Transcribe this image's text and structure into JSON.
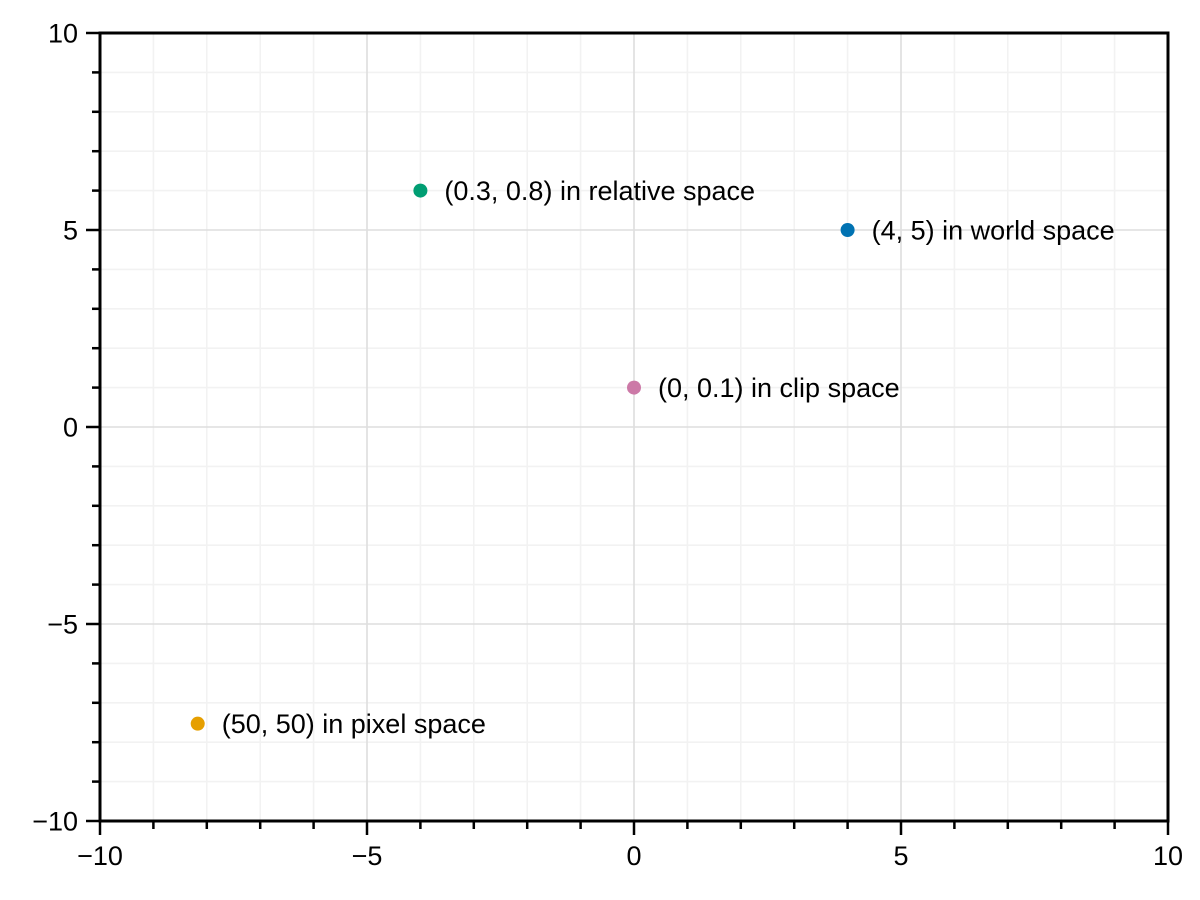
{
  "chart_data": {
    "type": "scatter",
    "title": "",
    "xlabel": "",
    "ylabel": "",
    "xlim": [
      -10,
      10
    ],
    "ylim": [
      -10,
      10
    ],
    "grid": {
      "minor": true,
      "major": true,
      "minor_step": 1,
      "major_step": 5
    },
    "legend_position": "none",
    "x_major_ticks": [
      -10,
      -5,
      0,
      5,
      10
    ],
    "x_major_tick_labels": [
      "−10",
      "−5",
      "0",
      "5",
      "10"
    ],
    "y_major_ticks": [
      -10,
      -5,
      0,
      5,
      10
    ],
    "y_major_tick_labels": [
      "−10",
      "−5",
      "0",
      "5",
      "10"
    ],
    "points": [
      {
        "x": -4,
        "y": 6,
        "color": "#009E73",
        "label": "(0.3, 0.8) in relative space"
      },
      {
        "x": 4,
        "y": 5,
        "color": "#0072B2",
        "label": "(4, 5) in world space"
      },
      {
        "x": 0,
        "y": 1,
        "color": "#CC79A7",
        "label": "(0, 0.1) in clip space"
      },
      {
        "x": -8.17,
        "y": -7.53,
        "color": "#E69F00",
        "label": "(50, 50) in pixel space"
      }
    ]
  },
  "style_colors": {
    "background": "#ffffff",
    "spine": "#000000",
    "tick": "#000000",
    "tick_label": "#000000",
    "point_label": "#000000",
    "grid_minor": "#f2f2f2",
    "grid_major": "#dedede"
  }
}
